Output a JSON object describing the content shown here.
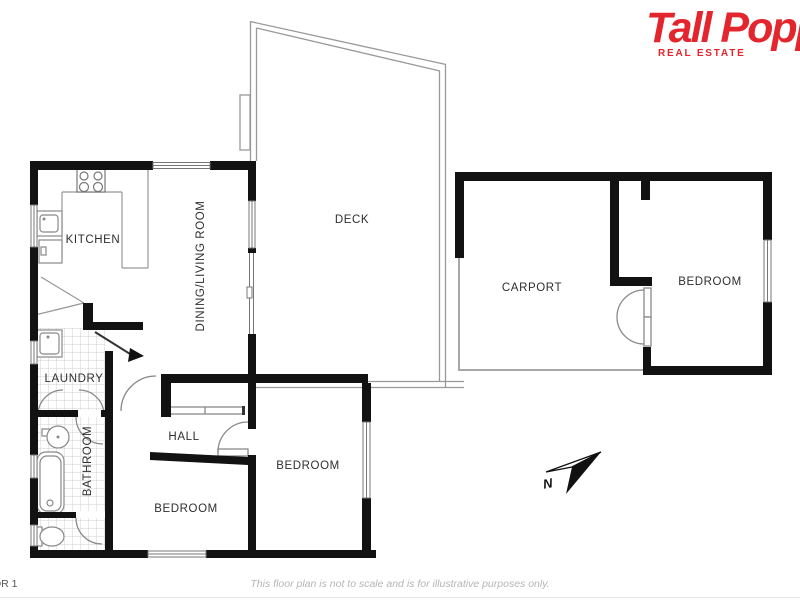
{
  "logo": {
    "brand": "Tall Popp",
    "tagline": "REAL ESTATE"
  },
  "rooms": {
    "kitchen": "KITCHEN",
    "dining_living": "DINING/LIVING ROOM",
    "deck": "DECK",
    "carport": "CARPORT",
    "bedroom_ne": "BEDROOM",
    "laundry": "LAUNDRY",
    "hall": "HALL",
    "bathroom": "BATHROOM",
    "bedroom_sw": "BEDROOM",
    "bedroom_s": "BEDROOM"
  },
  "compass": {
    "north_label": "N"
  },
  "footer": {
    "floor_label": "OR 1",
    "disclaimer": "This floor plan is not to scale and is for illustrative purposes only."
  },
  "colors": {
    "wall": "#121212",
    "thin_line": "#8f8f8f",
    "tile_line": "#d0d0d0",
    "brand_red": "#e3262e",
    "footer_gray": "#b5b5b5"
  }
}
